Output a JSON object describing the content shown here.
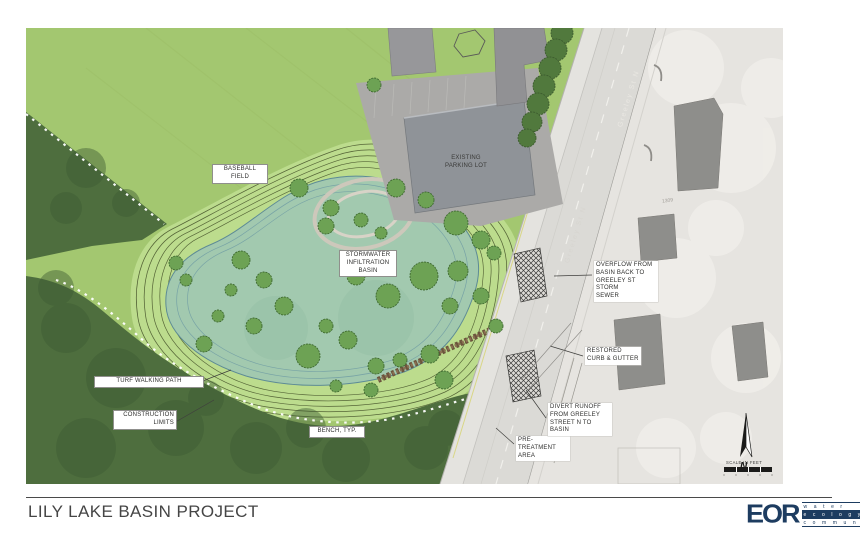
{
  "title_block": {
    "project_title": "LILY LAKE BASIN PROJECT",
    "logo": {
      "name": "EOR",
      "words": [
        "w a t e r",
        "e c o l o g y",
        "c o m m u n i t y"
      ]
    }
  },
  "map": {
    "labels": {
      "baseball_field": "BASEBALL\nFIELD",
      "existing_parking_lot": "EXISTING\nPARKING LOT",
      "stormwater_basin": "STORMWATER\nINFILTRATION\nBASIN",
      "turf_walking_path": "TURF WALKING PATH",
      "construction_limits": "CONSTRUCTION\nLIMITS",
      "bench_typ": "BENCH, TYP.",
      "pre_treatment_area": "PRE-TREATMENT\nAREA",
      "divert_runoff": "DIVERT RUNOFF\nFROM GREELEY\nSTREET N TO BASIN",
      "restored_curb_gutter": "RESTORED\nCURB & GUTTER",
      "overflow": "OVERFLOW FROM\nBASIN BACK TO\nGREELEY ST STORM\nSEWER"
    },
    "street_labels": {
      "greeley_top": "Greeley St N",
      "greeley_mid": "Greeley St N"
    },
    "annotations": {
      "house_number": "1309",
      "scale_caption": "SCALE IN FEET",
      "north_letter": "N"
    },
    "colors": {
      "field_green": "#a3c770",
      "forest_green": "#4e6e3e",
      "contour_band_green": "#bcdc8d",
      "basin_teal": "#a2c9af",
      "road_gray": "#dbdad6",
      "faded_aerial": "#e6e4e0",
      "building_gray": "#8e8e8b",
      "logo_navy": "#1d3c60"
    }
  }
}
